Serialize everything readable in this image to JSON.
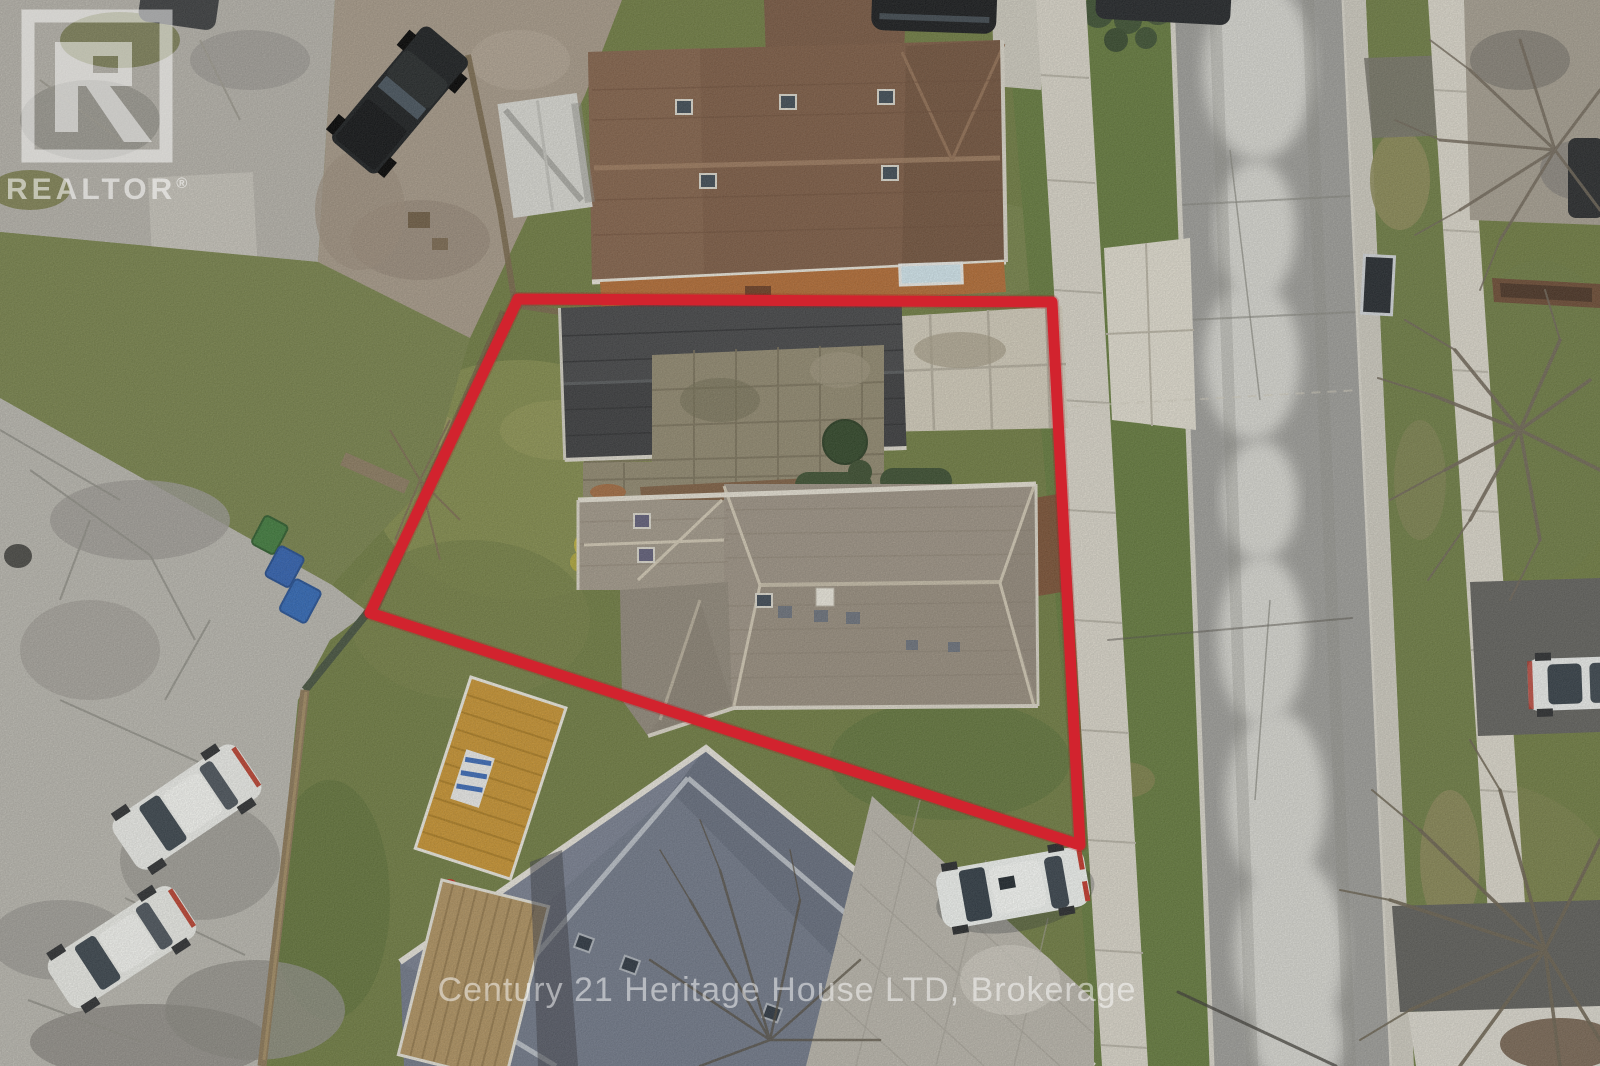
{
  "watermarks": {
    "realtor_logo": {
      "label": "REALTOR",
      "registered_mark": "®"
    },
    "brokerage": "Century 21 Heritage House LTD, Brokerage"
  },
  "colors": {
    "boundary_outline": "#d2232e",
    "watermark_text": "#ffffff"
  }
}
